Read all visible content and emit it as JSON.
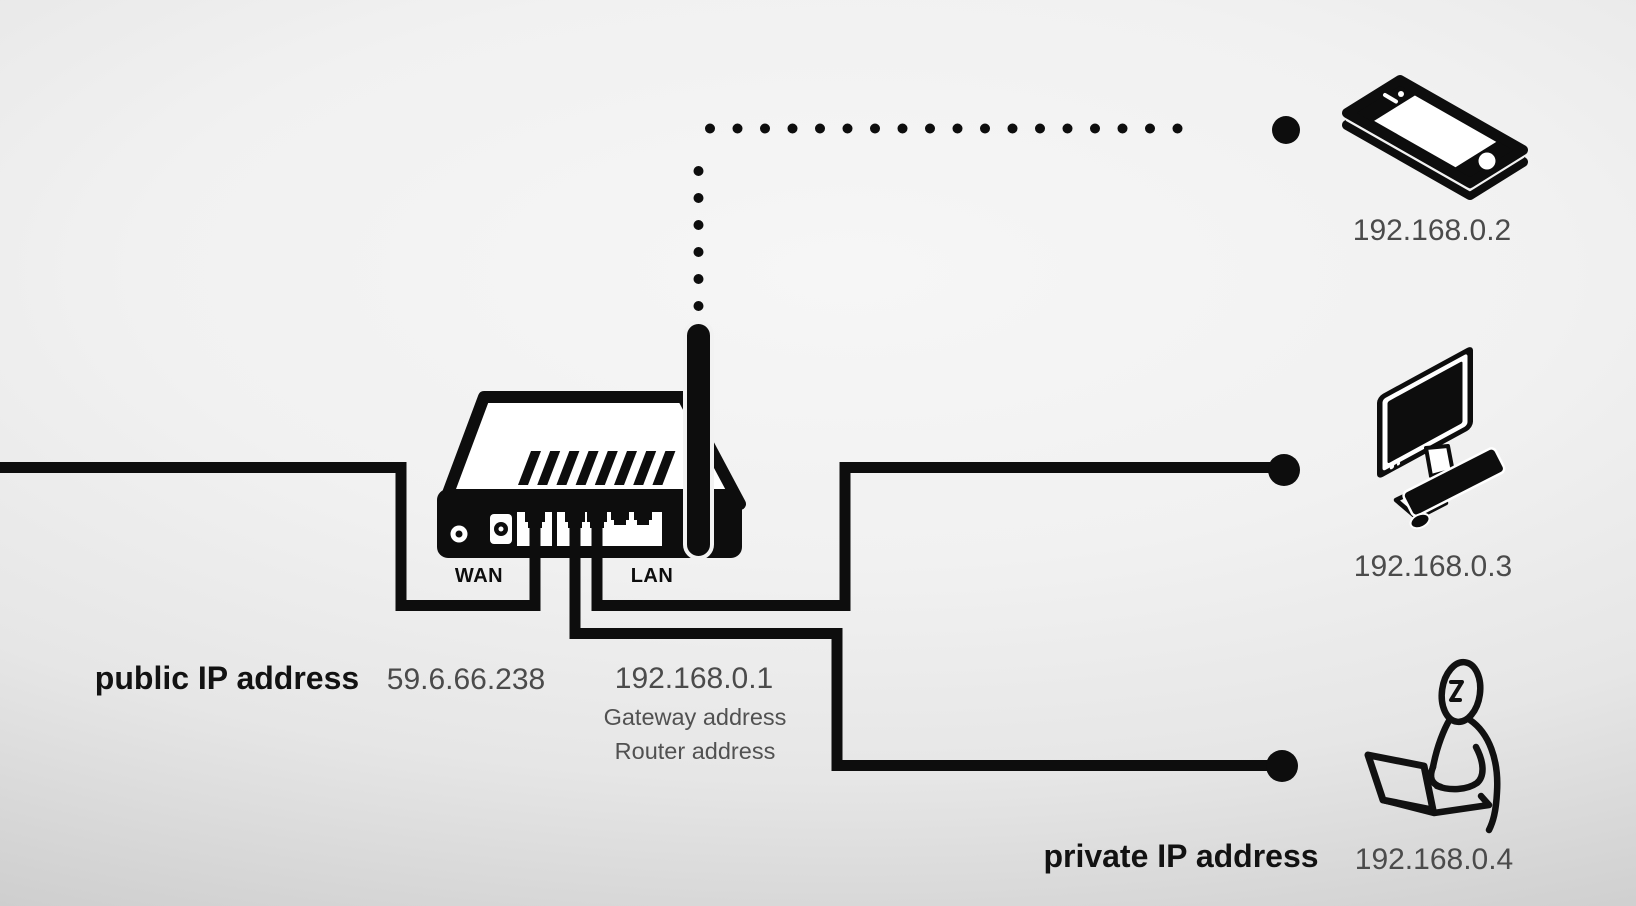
{
  "diagram": {
    "title_implied": "home network NAT diagram",
    "public_side": {
      "label": "public IP address",
      "ip": "59.6.66.238"
    },
    "router": {
      "wan_port_label": "WAN",
      "lan_port_label": "LAN",
      "ip": "192.168.0.1",
      "ip_role_1": "Gateway address",
      "ip_role_2": "Router address"
    },
    "private_side": {
      "label": "private IP address"
    },
    "devices": [
      {
        "type": "smartphone",
        "ip": "192.168.0.2",
        "link": "wireless-dotted"
      },
      {
        "type": "desktop-computer",
        "ip": "192.168.0.3",
        "link": "wired"
      },
      {
        "type": "person-with-laptop",
        "ip": "192.168.0.4",
        "link": "wired"
      }
    ],
    "colors": {
      "ink": "#0d0d0d",
      "label_text": "#121212",
      "value_text": "#4b4b4b",
      "background_top": "#e9e9e9",
      "background_mid": "#f4f4f4",
      "background_bottom": "#c9c9c9"
    }
  }
}
